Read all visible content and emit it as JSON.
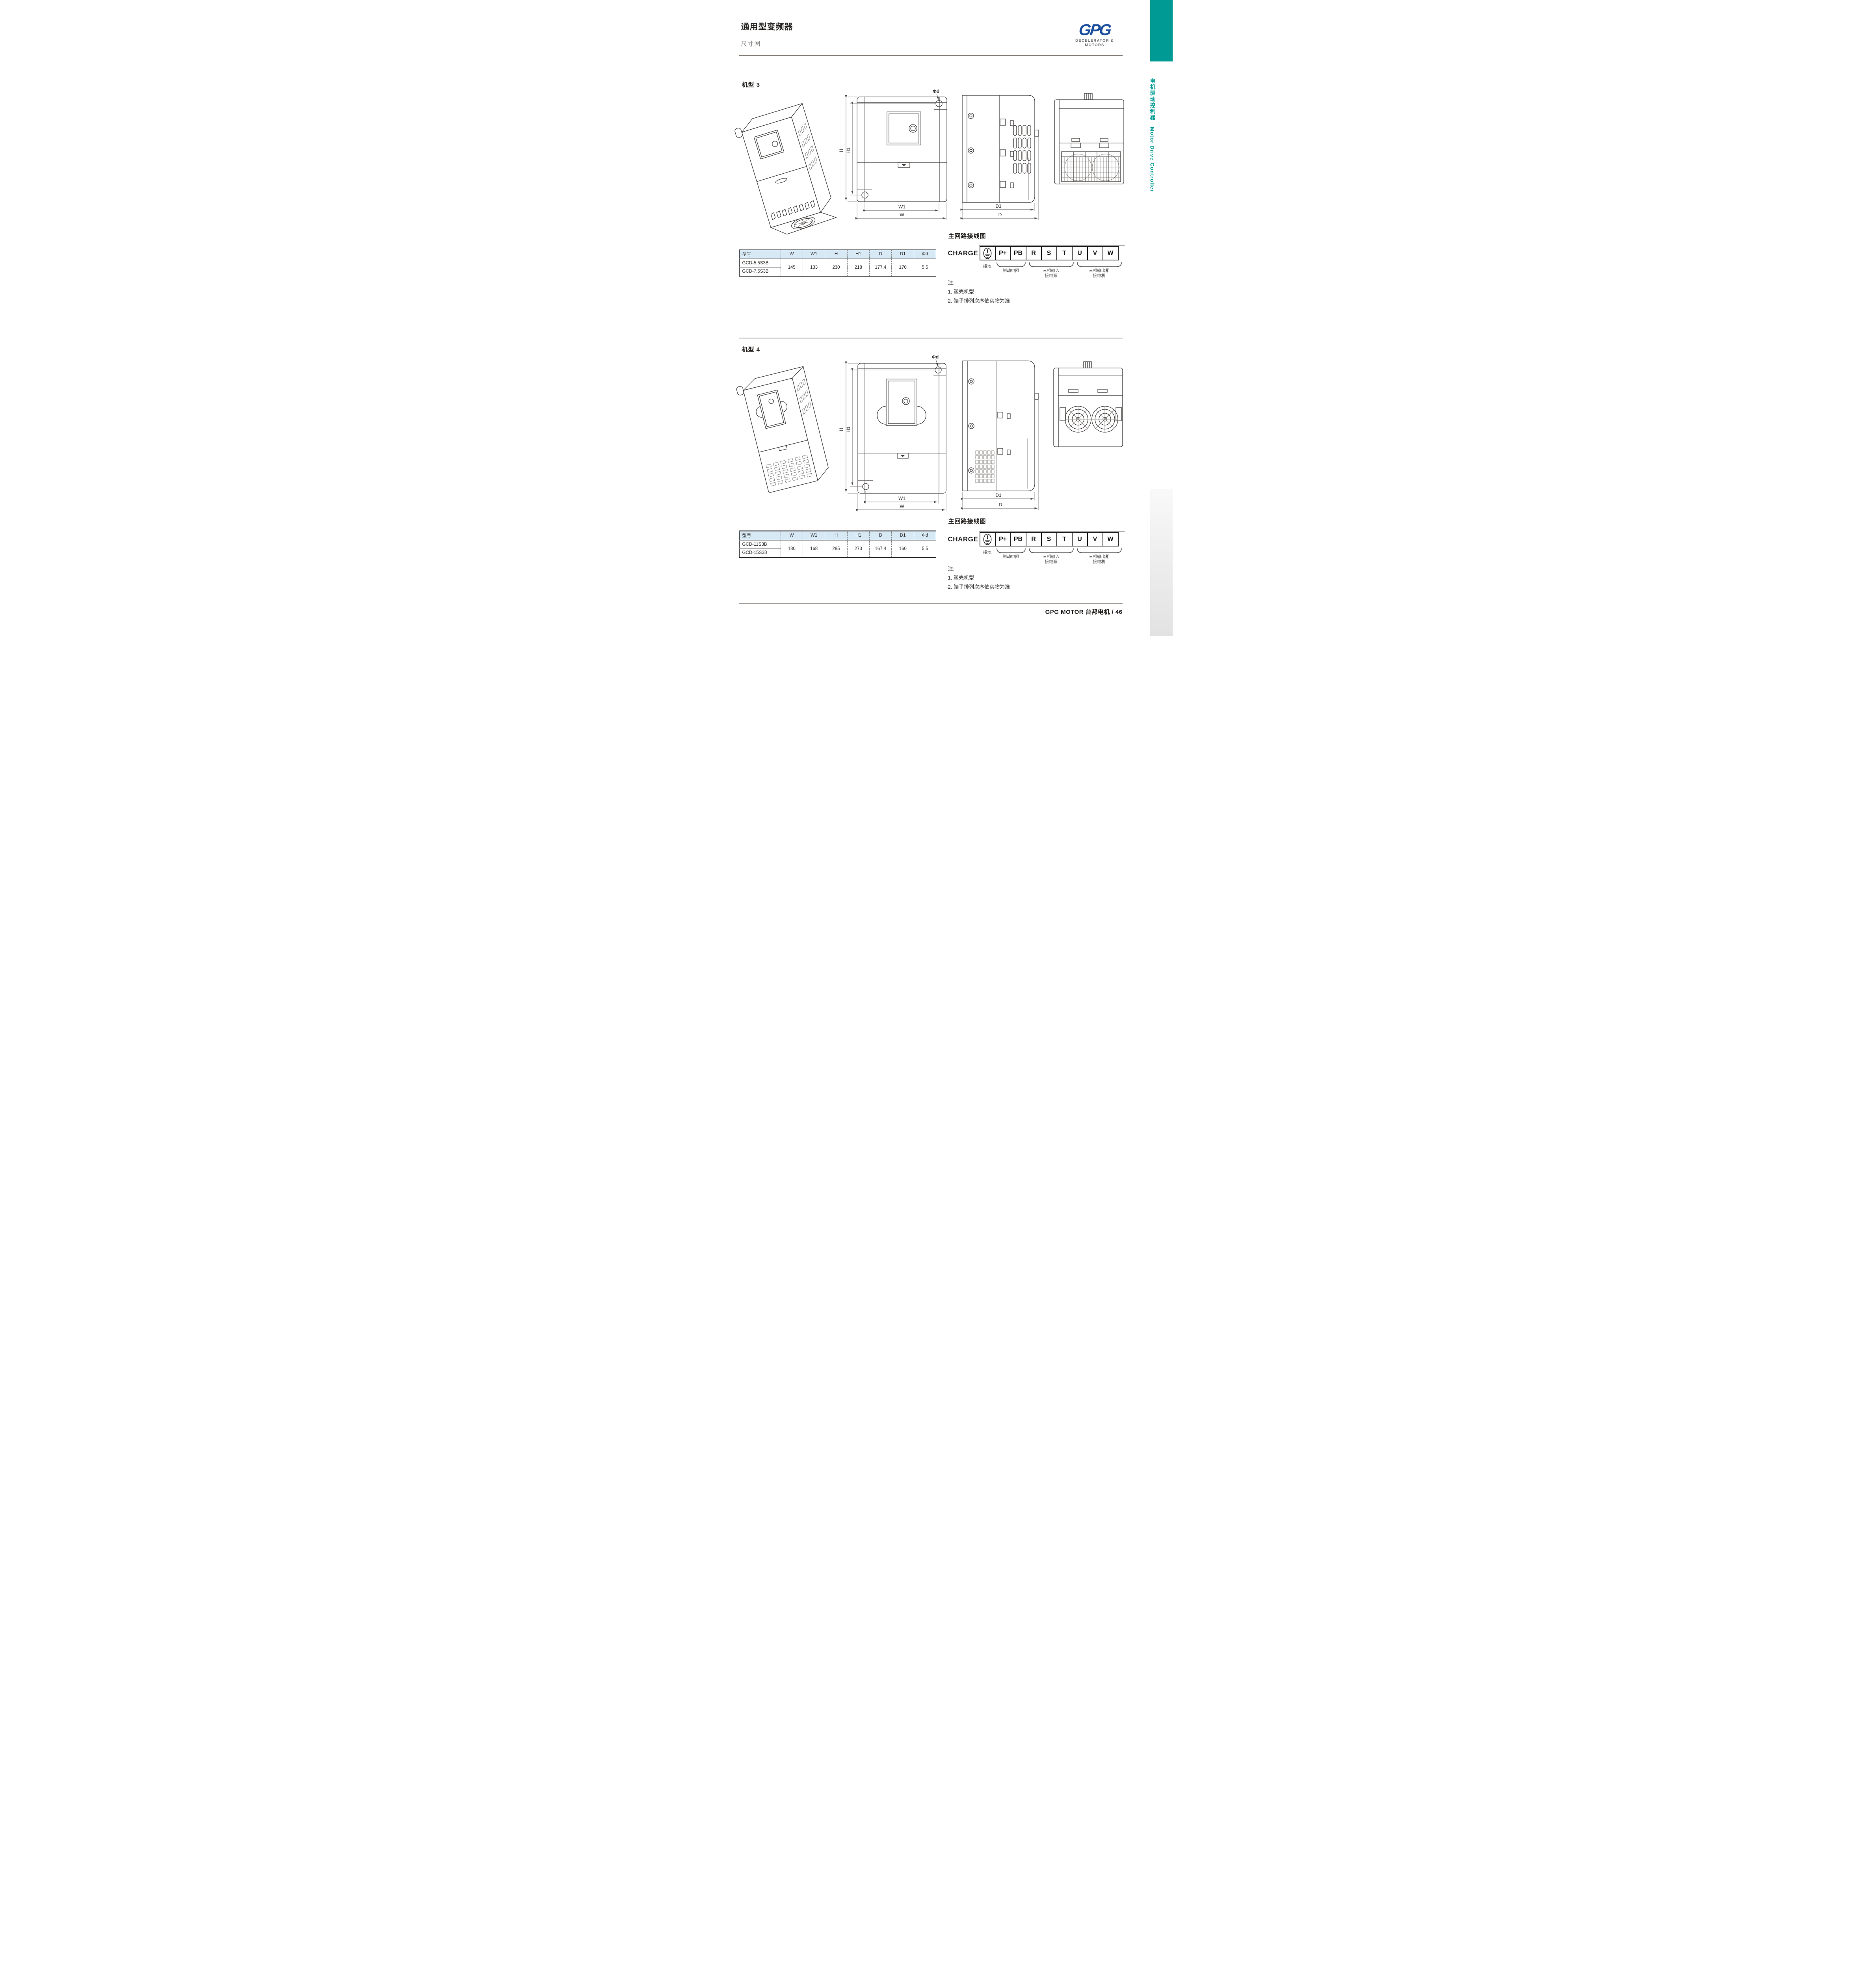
{
  "page": {
    "title": "通用型变频器",
    "subtitle": "尺寸图",
    "footer": "GPG MOTOR 台邦电机  /  46"
  },
  "logo": {
    "text": "GPG",
    "tagline": "DECELERATOR & MOTORS"
  },
  "sidebar": {
    "text_cn": "电机驱动控制器",
    "text_en": "Motor Drive Controller"
  },
  "colors": {
    "accent_teal": "#009a94",
    "logo_blue": "#1c4e9e",
    "table_header_bg": "#d8e9f6"
  },
  "dims": {
    "w": "W",
    "w1": "W1",
    "h": "H",
    "h1": "H1",
    "d": "D",
    "d1": "D1",
    "phid": "Φd"
  },
  "sections": [
    {
      "label": "机型 3",
      "table": {
        "headers": [
          "型号",
          "W",
          "W1",
          "H",
          "H1",
          "D",
          "D1",
          "Φd"
        ],
        "models": [
          "GCD-5.5S3B",
          "GCD-7.5S3B"
        ],
        "values": [
          "145",
          "133",
          "230",
          "218",
          "177.4",
          "170",
          "5.5"
        ]
      },
      "wiring": {
        "heading": "主回路接线图",
        "charge_label": "CHARGE",
        "terminals": [
          "P+",
          "PB",
          "R",
          "S",
          "T",
          "U",
          "V",
          "W"
        ],
        "ground_label": "接地",
        "brake_label": "制动电阻",
        "input_label_1": "三相输入",
        "input_label_2": "接电源",
        "output_label_1": "三相输出相",
        "output_label_2": "接电机"
      },
      "notes": {
        "title": "注:",
        "item1": "1. 塑壳机型",
        "item2": "2. 端子排列次序依实物为准"
      }
    },
    {
      "label": "机型 4",
      "table": {
        "headers": [
          "型号",
          "W",
          "W1",
          "H",
          "H1",
          "D",
          "D1",
          "Φd"
        ],
        "models": [
          "GCD-11S3B",
          "GCD-15S3B"
        ],
        "values": [
          "180",
          "168",
          "285",
          "273",
          "167.4",
          "160",
          "5.5"
        ]
      },
      "wiring": {
        "heading": "主回路接线图",
        "charge_label": "CHARGE",
        "terminals": [
          "P+",
          "PB",
          "R",
          "S",
          "T",
          "U",
          "V",
          "W"
        ],
        "ground_label": "接地",
        "brake_label": "制动电阻",
        "input_label_1": "三相输入",
        "input_label_2": "接电源",
        "output_label_1": "三相输出相",
        "output_label_2": "接电机"
      },
      "notes": {
        "title": "注:",
        "item1": "1. 塑壳机型",
        "item2": "2. 端子排列次序依实物为准"
      }
    }
  ]
}
